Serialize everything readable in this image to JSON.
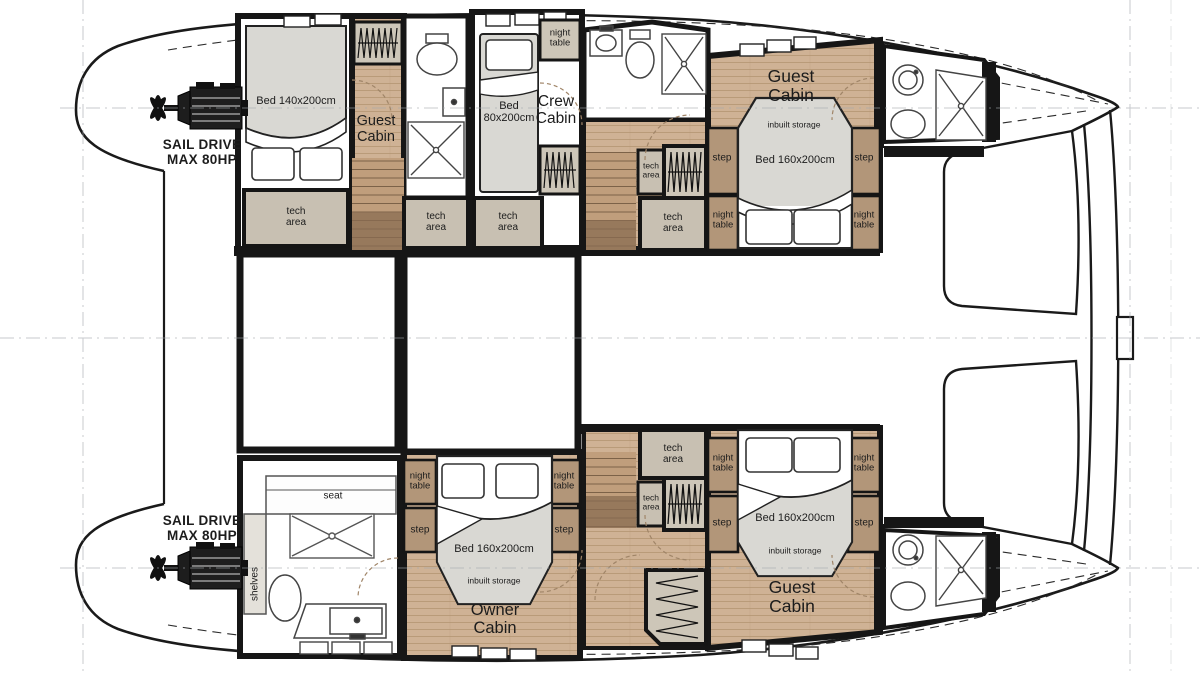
{
  "title": "Catamaran lower deck layout plan",
  "engine": {
    "line1": "SAIL DRIVE",
    "line2": "MAX 80HP"
  },
  "labels": {
    "tech_area": "tech area",
    "night_table": "night table",
    "step": "step",
    "inbuilt_storage": "inbuilt storage",
    "seat": "seat",
    "shelves": "shelves"
  },
  "cabins": {
    "guest_aft_port": {
      "name": "Guest Cabin",
      "bed": "Bed 140x200cm"
    },
    "crew": {
      "name": "Crew Cabin",
      "bed": "Bed 80x200cm"
    },
    "guest_fwd_port": {
      "name": "Guest Cabin",
      "bed": "Bed 160x200cm"
    },
    "owner": {
      "name": "Owner Cabin",
      "bed": "Bed 160x200cm"
    },
    "guest_fwd_stbd": {
      "name": "Guest Cabin",
      "bed": "Bed 160x200cm"
    }
  },
  "colors": {
    "wall": "#161616",
    "outline": "#1a1a1a",
    "wood": "#cfb295",
    "plank_line": "#b2936f",
    "stair_dark": "#8a6c52",
    "tech_fill": "#c8c0b2",
    "cabinet_fill": "#cdc6b8",
    "night_table_fill": "#b29679",
    "mattress": "#d9d8d3",
    "reference_line": "#a3a8ae"
  }
}
